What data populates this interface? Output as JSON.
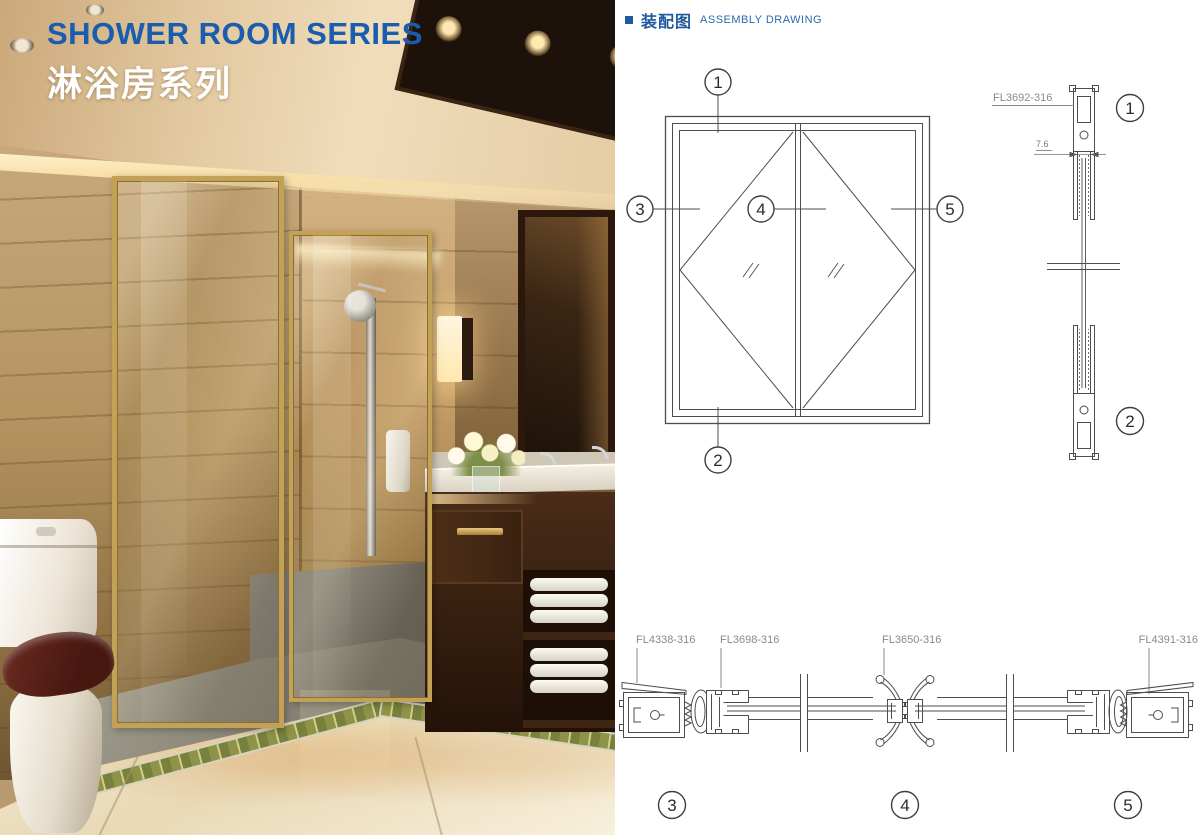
{
  "page_title": {
    "en": "SHOWER ROOM SERIES",
    "zh": "淋浴房系列"
  },
  "assembly_header": {
    "zh": "装配图",
    "en": "ASSEMBLY DRAWING"
  },
  "front_view": {
    "callout_1": "1",
    "callout_2": "2",
    "callout_3": "3",
    "callout_4": "4",
    "callout_5": "5"
  },
  "side_view": {
    "part_label": "FL3692-316",
    "dimension": "7.6",
    "callout_top": "1",
    "callout_bottom": "2"
  },
  "section_view": {
    "part_1": "FL4338-316",
    "part_2": "FL3698-316",
    "part_3": "FL3650-316",
    "part_4": "FL4391-316",
    "callout_3": "3",
    "callout_4": "4",
    "callout_5": "5"
  },
  "colors": {
    "title_blue": "#1a5cae",
    "heading_blue": "#1e5a9e",
    "label_gray": "#8a8a8a",
    "line_gray": "#4d4d4d",
    "frame_gold": "#c3a258"
  }
}
